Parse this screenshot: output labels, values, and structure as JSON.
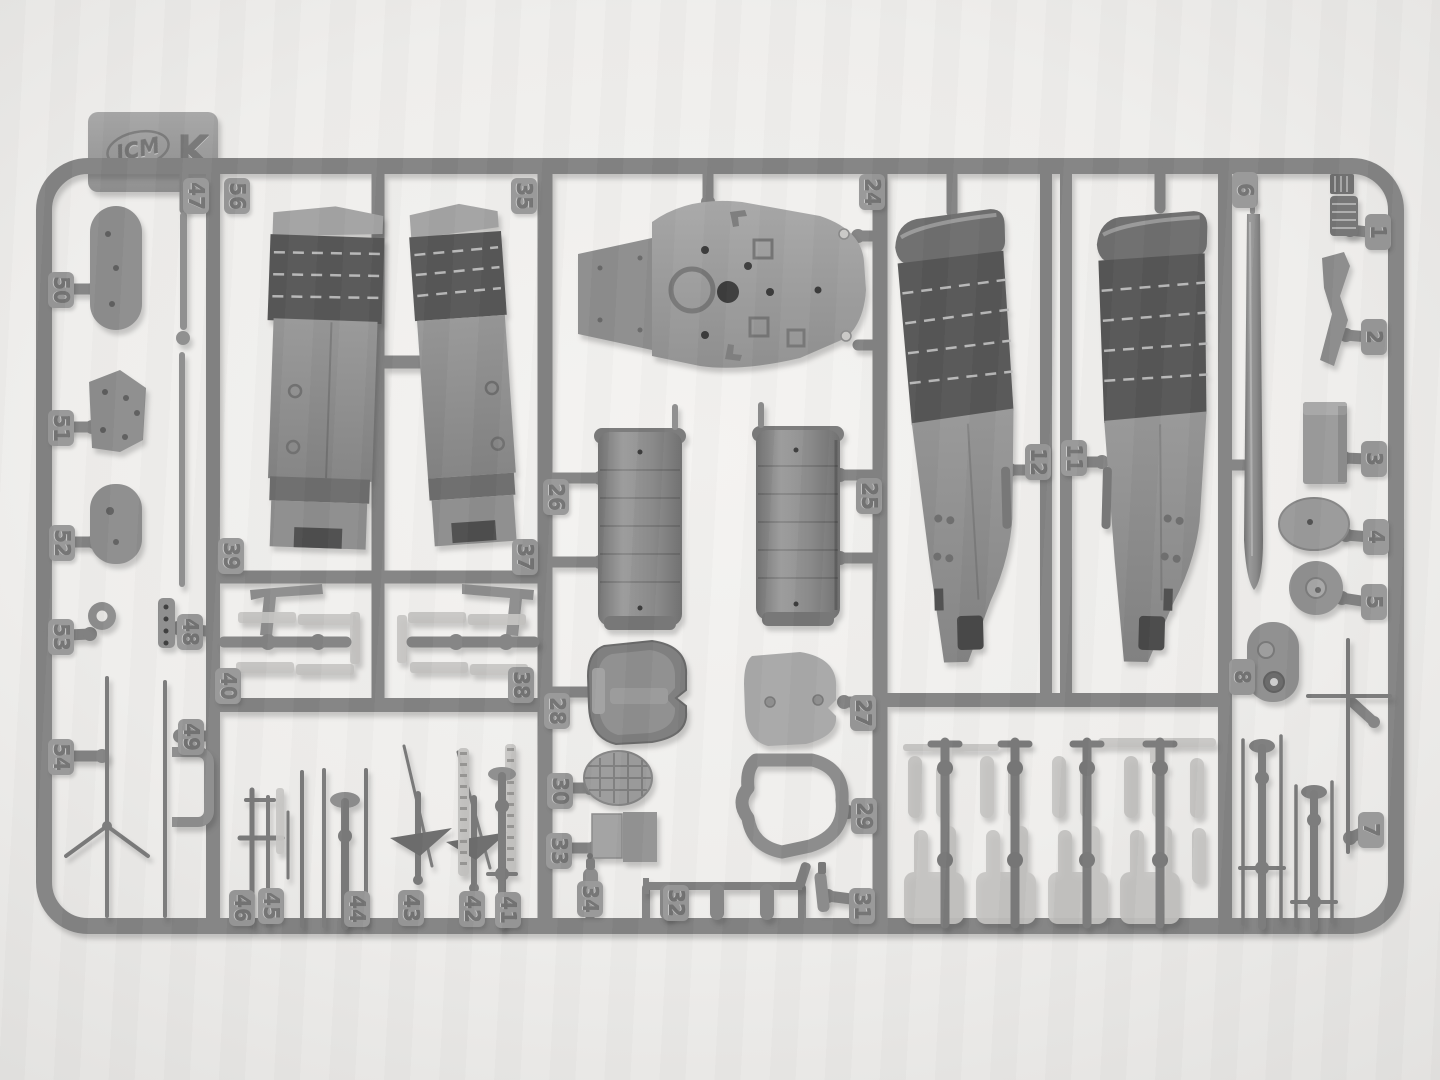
{
  "meta": {
    "description": "Photograph of a gray injection-molded plastic model kit parts sprue on a light background",
    "brand_logo": "ICM",
    "sprue_letter": "K"
  },
  "colors": {
    "background": "#efeeec",
    "frame": "#848484",
    "tag_pad": "#989898",
    "tag_plate": "#9d9d9d",
    "part_light": "#a4a4a4",
    "part_mid": "#8e8e8e",
    "part_dark": "#6e6e6e",
    "part_darker": "#585858",
    "part_flat": "#c5c4c2",
    "emboss": "#747474"
  },
  "part_tags": [
    {
      "label": "47",
      "x": 196,
      "y": 196
    },
    {
      "label": "56",
      "x": 237,
      "y": 196
    },
    {
      "label": "35",
      "x": 524,
      "y": 196
    },
    {
      "label": "24",
      "x": 872,
      "y": 192,
      "stub": [
        874,
        236,
        858,
        236
      ]
    },
    {
      "label": "6",
      "x": 1245,
      "y": 190
    },
    {
      "label": "1",
      "x": 1378,
      "y": 232,
      "stub": [
        1368,
        232,
        1350,
        230
      ]
    },
    {
      "label": "2",
      "x": 1374,
      "y": 337,
      "stub": [
        1368,
        337,
        1346,
        335
      ]
    },
    {
      "label": "3",
      "x": 1374,
      "y": 459,
      "stub": [
        1368,
        459,
        1344,
        458
      ]
    },
    {
      "label": "4",
      "x": 1376,
      "y": 537,
      "stub": [
        1370,
        537,
        1346,
        535
      ]
    },
    {
      "label": "5",
      "x": 1374,
      "y": 602,
      "stub": [
        1368,
        602,
        1342,
        598
      ]
    },
    {
      "label": "8",
      "x": 1242,
      "y": 677,
      "stub": [
        1233,
        677,
        1252,
        677
      ]
    },
    {
      "label": "7",
      "x": 1371,
      "y": 830,
      "stub": [
        1363,
        832,
        1350,
        838
      ]
    },
    {
      "label": "12",
      "x": 1038,
      "y": 462,
      "stub": [
        1044,
        470,
        1010,
        470
      ]
    },
    {
      "label": "11",
      "x": 1074,
      "y": 458,
      "stub": [
        1068,
        462,
        1102,
        462
      ]
    },
    {
      "label": "26",
      "x": 556,
      "y": 497,
      "stub": [
        551,
        478,
        600,
        478
      ]
    },
    {
      "label": "25",
      "x": 869,
      "y": 496,
      "stub": [
        874,
        475,
        840,
        475
      ]
    },
    {
      "label": "28",
      "x": 557,
      "y": 711,
      "stub": [
        551,
        692,
        592,
        692
      ]
    },
    {
      "label": "27",
      "x": 863,
      "y": 713,
      "stub": [
        874,
        702,
        844,
        702
      ]
    },
    {
      "label": "30",
      "x": 560,
      "y": 791,
      "stub": [
        551,
        788,
        590,
        788
      ]
    },
    {
      "label": "33",
      "x": 559,
      "y": 851,
      "stub": [
        551,
        848,
        594,
        848
      ]
    },
    {
      "label": "29",
      "x": 864,
      "y": 816,
      "stub": [
        874,
        812,
        848,
        812
      ]
    },
    {
      "label": "34",
      "x": 590,
      "y": 899
    },
    {
      "label": "32",
      "x": 676,
      "y": 903
    },
    {
      "label": "31",
      "x": 862,
      "y": 906,
      "stub": [
        874,
        902,
        828,
        896
      ]
    },
    {
      "label": "50",
      "x": 61,
      "y": 290,
      "stub": [
        47,
        289,
        94,
        289
      ]
    },
    {
      "label": "51",
      "x": 61,
      "y": 428,
      "stub": [
        47,
        427,
        92,
        427
      ]
    },
    {
      "label": "52",
      "x": 62,
      "y": 543,
      "stub": [
        47,
        542,
        94,
        542
      ]
    },
    {
      "label": "53",
      "x": 61,
      "y": 637,
      "stub": [
        47,
        636,
        90,
        634
      ]
    },
    {
      "label": "54",
      "x": 61,
      "y": 757,
      "stub": [
        47,
        756,
        102,
        756
      ]
    },
    {
      "label": "48",
      "x": 190,
      "y": 632,
      "stub": [
        206,
        631,
        178,
        628
      ]
    },
    {
      "label": "49",
      "x": 191,
      "y": 737,
      "stub": [
        206,
        736,
        180,
        736
      ]
    },
    {
      "label": "39",
      "x": 231,
      "y": 556
    },
    {
      "label": "40",
      "x": 228,
      "y": 686
    },
    {
      "label": "37",
      "x": 525,
      "y": 557
    },
    {
      "label": "38",
      "x": 521,
      "y": 685
    },
    {
      "label": "46",
      "x": 242,
      "y": 908
    },
    {
      "label": "45",
      "x": 271,
      "y": 906
    },
    {
      "label": "44",
      "x": 357,
      "y": 909
    },
    {
      "label": "43",
      "x": 411,
      "y": 908
    },
    {
      "label": "42",
      "x": 472,
      "y": 909
    },
    {
      "label": "41",
      "x": 508,
      "y": 910
    }
  ]
}
